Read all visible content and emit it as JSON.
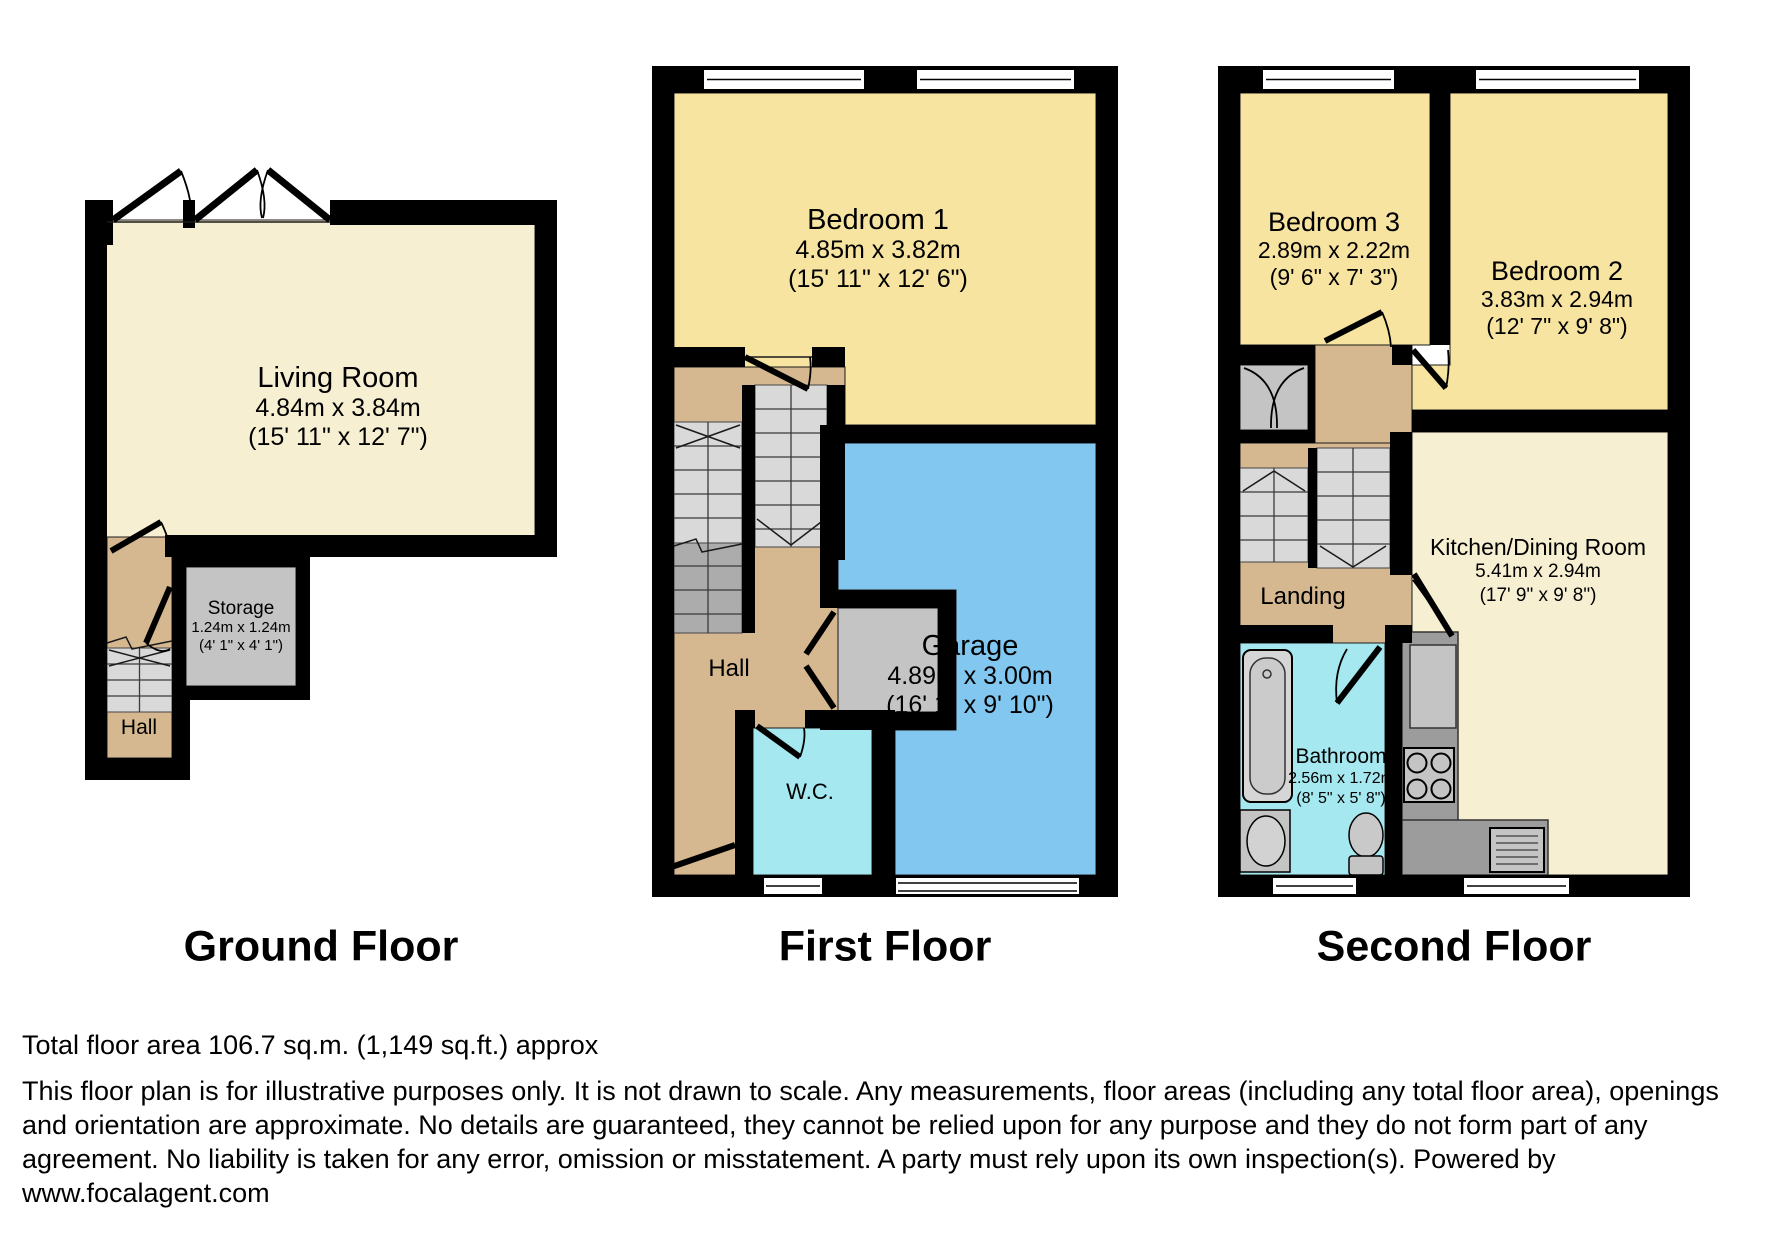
{
  "floors": [
    {
      "id": "ground",
      "label": "Ground Floor",
      "rooms": [
        {
          "id": "living-room",
          "name": "Living Room",
          "metric": "4.84m x 3.84m",
          "imperial": "(15' 11\" x 12' 7\")"
        },
        {
          "id": "storage",
          "name": "Storage",
          "metric": "1.24m x 1.24m",
          "imperial": "(4' 1\" x 4' 1\")"
        },
        {
          "id": "hall",
          "name": "Hall"
        }
      ]
    },
    {
      "id": "first",
      "label": "First Floor",
      "rooms": [
        {
          "id": "bedroom-1",
          "name": "Bedroom 1",
          "metric": "4.85m x 3.82m",
          "imperial": "(15' 11\" x 12' 6\")"
        },
        {
          "id": "hall",
          "name": "Hall"
        },
        {
          "id": "wc",
          "name": "W.C."
        },
        {
          "id": "garage",
          "name": "Garage",
          "metric": "4.89m x 3.00m",
          "imperial": "(16' 1\" x 9' 10\")"
        }
      ]
    },
    {
      "id": "second",
      "label": "Second Floor",
      "rooms": [
        {
          "id": "bedroom-3",
          "name": "Bedroom 3",
          "metric": "2.89m x 2.22m",
          "imperial": "(9' 6\" x 7' 3\")"
        },
        {
          "id": "bedroom-2",
          "name": "Bedroom 2",
          "metric": "3.83m x 2.94m",
          "imperial": "(12' 7\" x 9' 8\")"
        },
        {
          "id": "landing",
          "name": "Landing"
        },
        {
          "id": "bathroom",
          "name": "Bathroom",
          "metric": "2.56m x 1.72m",
          "imperial": "(8' 5\" x 5' 8\")"
        },
        {
          "id": "kitchen-dining",
          "name": "Kitchen/Dining Room",
          "metric": "5.41m x 2.94m",
          "imperial": "(17' 9\" x 9' 8\")"
        }
      ]
    }
  ],
  "footer": {
    "total_area": "Total floor area 106.7 sq.m. (1,149 sq.ft.) approx",
    "disclaimer": "This floor plan is for illustrative purposes only. It is not drawn to scale. Any measurements, floor areas (including any total floor area), openings and orientation are approximate. No details are guaranteed, they cannot be relied upon for any purpose and they do not form part of any agreement. No liability is taken for any error, omission or misstatement. A party must rely upon its own inspection(s). Powered by www.focalagent.com"
  },
  "colors": {
    "room_cream": "#F7EFD2",
    "bedroom_yellow": "#F7E4A0",
    "garage_blue": "#82C7F0",
    "bathroom_cyan": "#A5E8F0",
    "hall_tan": "#D5B890",
    "stairs_gray": "#D9D9D9",
    "stairs_dark_gray": "#ACACAC",
    "storage_gray": "#C4C4C4",
    "counter_gray": "#9C9C9C",
    "wall_black": "#000000"
  }
}
